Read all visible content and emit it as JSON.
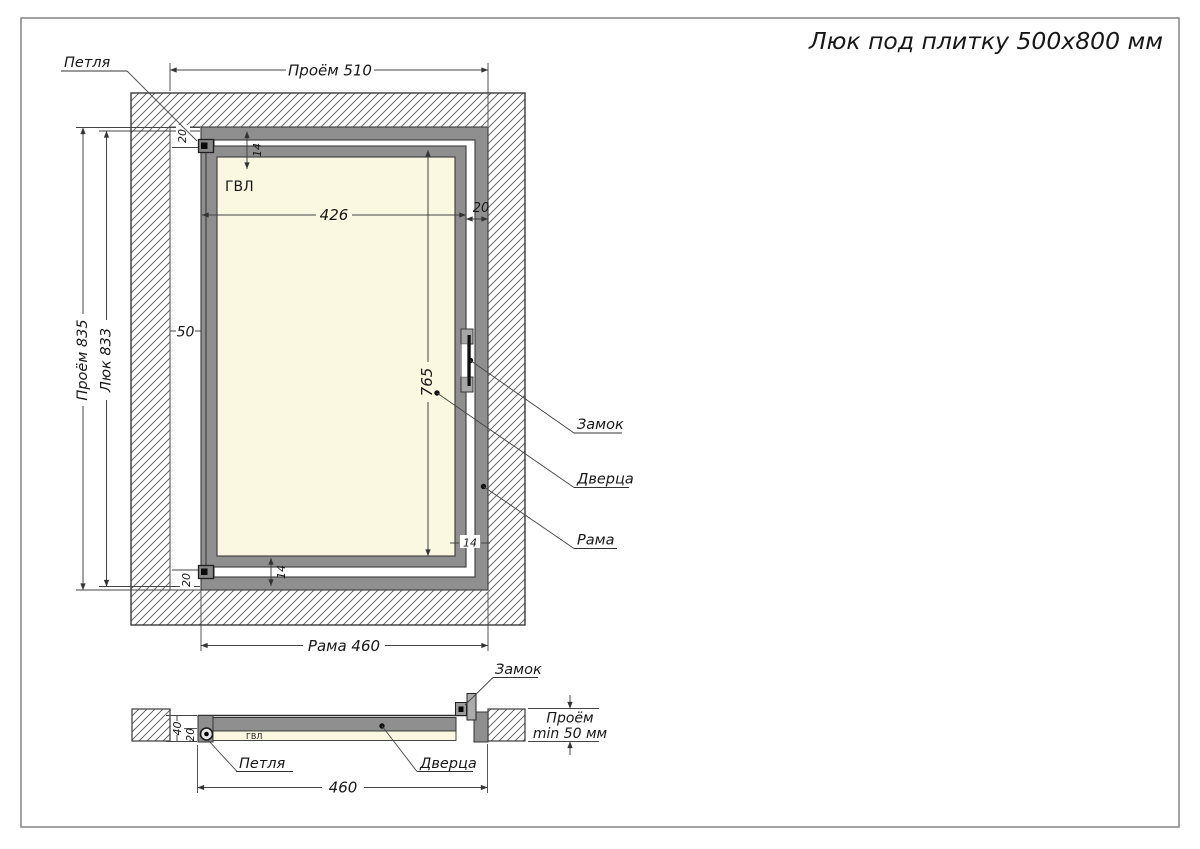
{
  "title": "Люк под плитку 500х800 мм",
  "front": {
    "hinge_label": "Петля",
    "lock_label": "Замок",
    "door_label": "Дверца",
    "frame_label": "Рама",
    "material_label": "ГВЛ",
    "dim_opening_width": "Проём 510",
    "dim_opening_height": "Проём 835",
    "dim_hatch_height": "Люк 833",
    "dim_frame_width": "Рама 460",
    "dim_door_width": "426",
    "dim_door_height": "765",
    "dim_offset_left": "50",
    "dim_gap_right": "20",
    "dim_hinge_top": "20",
    "dim_hinge_bottom": "20",
    "dim_gap_top": "14",
    "dim_gap_bottom": "14",
    "dim_gap_bottom_right": "14"
  },
  "section": {
    "hinge_label": "Петля",
    "lock_label": "Замок",
    "door_label": "Дверца",
    "material_label": "ГВЛ",
    "dim_frame_width": "460",
    "dim_depth_total": "40",
    "dim_depth_door": "20",
    "dim_opening_depth_line1": "Проём",
    "dim_opening_depth_line2": "min 50 мм"
  },
  "colors": {
    "frame_gray": "#8f8f8f",
    "panel_cream": "#faf8e1",
    "line": "#3a3a3a"
  }
}
